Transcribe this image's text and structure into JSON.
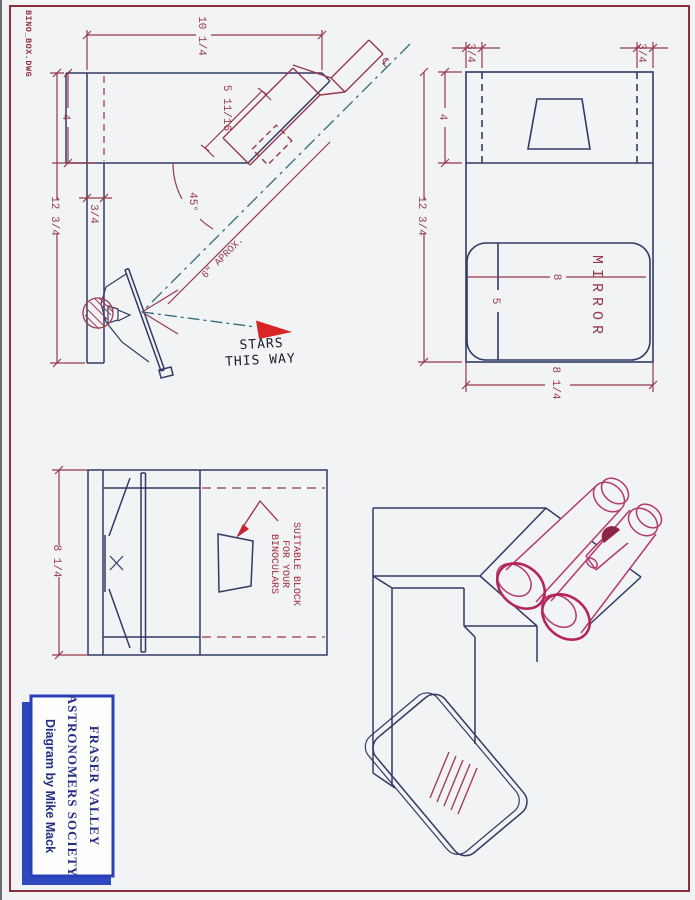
{
  "page": {
    "filename": "BINO_BOX.DWG"
  },
  "colors": {
    "background": "#f1f3f5",
    "frame": "#8a2f3c",
    "outline_navy": "#323b64",
    "dimension_maroon": "#97394a",
    "centerline_teal": "#2f6b79",
    "binocular_magenta": "#b53a6e",
    "arrow_red": "#d92525",
    "title_blue": "#2b3eb8"
  },
  "side_view": {
    "dim_top_width": "10 1/4",
    "dim_tube_length": "5 11/16",
    "dim_upper_height": "4",
    "dim_total_height": "12 3/4",
    "dim_board_thickness": "3/4",
    "dim_angle": "45°",
    "dim_mirror_distance": "6\" APROX.",
    "centerline_symbol": "℄",
    "stars_line1": "STARS",
    "stars_line2": "THIS WAY"
  },
  "top_view": {
    "dim_left_inset": "3/4",
    "dim_right_inset": "3/4",
    "dim_upper_height": "4",
    "dim_total_height": "12 3/4",
    "dim_mirror_width": "8",
    "dim_mirror_height": "5",
    "dim_total_width": "8 1/4",
    "mirror_label": "MIRROR"
  },
  "front_view": {
    "dim_height": "8 1/4",
    "note_line1": "SUITABLE BLOCK",
    "note_line2": "FOR YOUR",
    "note_line3": "BINOCULARS"
  },
  "title_block": {
    "line1": "FRASER VALLEY",
    "line2": "ASTRONOMERS SOCIETY",
    "line3": "Diagram by Mike Mack"
  }
}
